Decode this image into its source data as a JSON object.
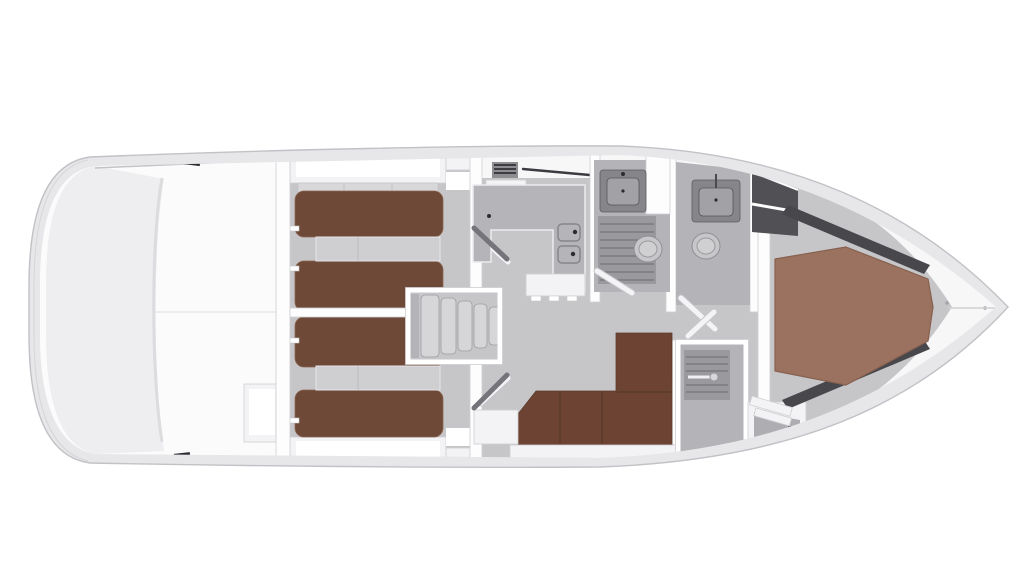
{
  "scene": {
    "type": "yacht-deck-floorplan",
    "view": "top-down-3d-render",
    "orientation": "bow-right-stern-left"
  },
  "colors": {
    "background": "#ffffff",
    "hull_band": "#e7e7ea",
    "hull_edge": "#c2c2c6",
    "deck_white": "#f7f7f8",
    "inner_edge": "#d6d6d9",
    "floor_gray": "#c6c6c9",
    "floor_dark": "#b4b4b8",
    "wall_white": "#fdfdfe",
    "wall_edge": "#cfcfd3",
    "berth_brown": "#6f4938",
    "sofa_brown": "#6d4434",
    "master_brown": "#9b7260",
    "counter_gray": "#b5b5b9",
    "fixture_gray": "#85858a",
    "slat_gray": "#9a9a9e",
    "dark_accent": "#3c3c40",
    "step_gray": "#d6d6d9",
    "shadow_gray": "#9e9ea2"
  },
  "regions": [
    {
      "name": "stern-garage",
      "desc": "empty white aft platform / garage space"
    },
    {
      "name": "aft-cabin-port",
      "desc": "two brown berths with lockers"
    },
    {
      "name": "aft-cabin-starboard",
      "desc": "two brown berths with lockers"
    },
    {
      "name": "companionway-stairs",
      "desc": "steps between the aft cabins"
    },
    {
      "name": "galley",
      "desc": "U-shaped counter with twin sinks and hob"
    },
    {
      "name": "mid-head",
      "desc": "washbasin, shower grating and toilet"
    },
    {
      "name": "forward-head",
      "desc": "washbasin and toilet"
    },
    {
      "name": "salon",
      "desc": "L-shaped brown settee"
    },
    {
      "name": "shower-stall",
      "desc": "separate shower with grating and door handle"
    },
    {
      "name": "wardrobe",
      "desc": "locker at master cabin entry"
    },
    {
      "name": "master-cabin",
      "desc": "hexagonal island double bed in the bow"
    }
  ]
}
